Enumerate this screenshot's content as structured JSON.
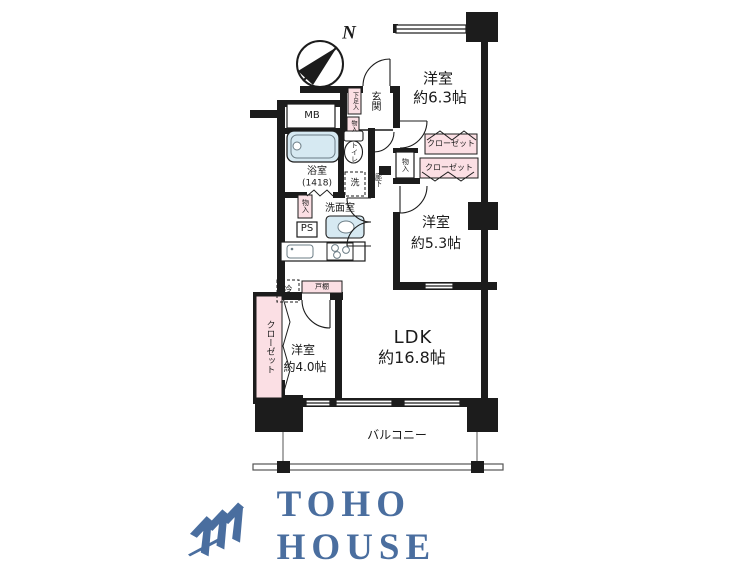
{
  "page": {
    "background": "#ffffff"
  },
  "compass": {
    "label": "N"
  },
  "rooms": {
    "bedroom1": {
      "name": "洋室",
      "size": "約6.3帖"
    },
    "bedroom2": {
      "name": "洋室",
      "size": "約5.3帖"
    },
    "bedroom3": {
      "name": "洋室",
      "size": "約4.0帖"
    },
    "ldk": {
      "name": "LDK",
      "size": "約16.8帖"
    },
    "balcony": {
      "name": "バルコニー"
    },
    "entrance": {
      "name": "玄関"
    },
    "hallway": {
      "name": "廊下"
    },
    "bathroom": {
      "name": "浴室",
      "size": "(1418)"
    },
    "washroom": {
      "name": "洗面室"
    },
    "toilet": {
      "name": "トイレ"
    }
  },
  "fixtures": {
    "meter_box": "MB",
    "pipe_space": "PS",
    "washer": "洗",
    "fridge": "冷",
    "cupboard": "戸棚",
    "shoe_cabinet": "下足入",
    "closet_bedroom1": "クローゼット",
    "closet_bedroom2": "クローゼット",
    "closet_bedroom3": "クローゼット",
    "storage_washroom": "物入",
    "storage_entrance": "物入",
    "storage_hall": "物入"
  },
  "logo": {
    "text": "TOHO HOUSE",
    "color": "#4a6e9f"
  },
  "colors": {
    "wall": "#1c1c1c",
    "closet": "#fbdfe4",
    "water": "#d6e9f2"
  }
}
